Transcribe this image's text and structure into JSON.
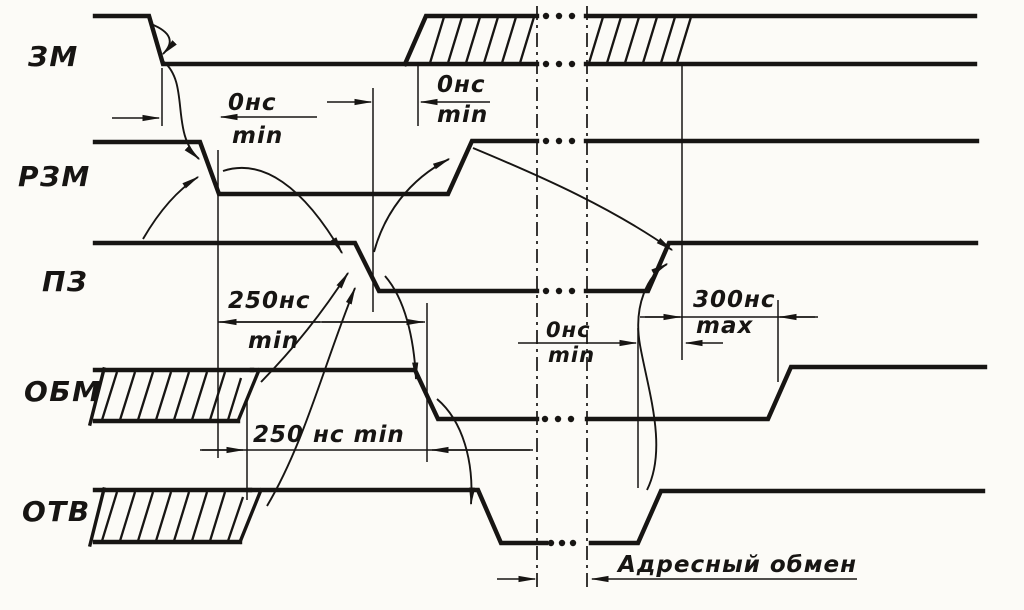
{
  "diagram": {
    "kind": "timing-diagram",
    "ink": "#171513",
    "paper": "#fcfbf7",
    "signals": [
      {
        "id": "zm",
        "label": "ЗМ"
      },
      {
        "id": "rzm",
        "label": "РЗМ"
      },
      {
        "id": "pz",
        "label": "ПЗ"
      },
      {
        "id": "obm",
        "label": "ОБМ"
      },
      {
        "id": "otv",
        "label": "ОТВ"
      }
    ],
    "annotations": {
      "d1": {
        "value": "0нс",
        "qualifier": "min"
      },
      "d2": {
        "value": "0нс",
        "qualifier": "min"
      },
      "d3": {
        "value": "250нс",
        "qualifier": "min"
      },
      "d4": {
        "value": "0нс",
        "qualifier": "min"
      },
      "d5": {
        "value": "300нс",
        "qualifier": "max"
      },
      "d6": {
        "value": "250 нс min"
      },
      "d7": {
        "value": "Адресный обмен"
      }
    }
  }
}
